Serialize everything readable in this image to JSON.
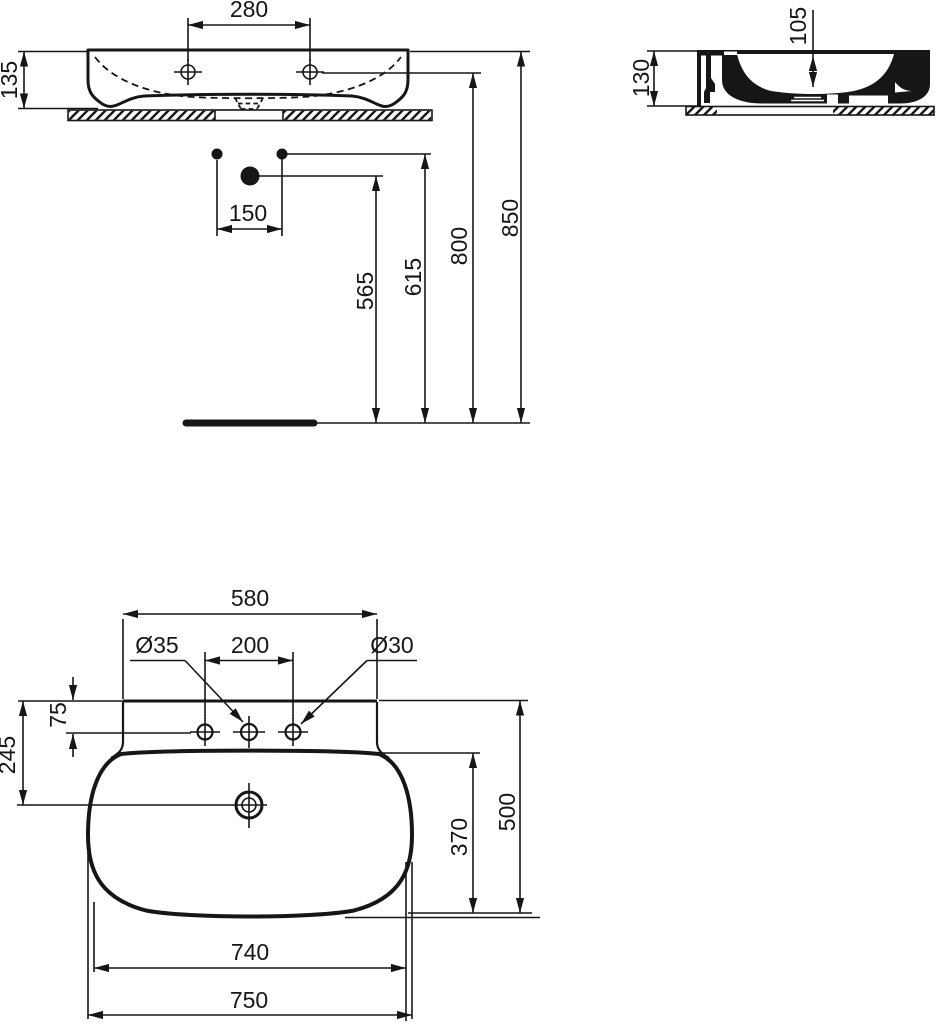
{
  "drawing": {
    "title": "wall-hung washbasin technical drawing",
    "units": "mm",
    "front": {
      "tap_hole_spacing": "280",
      "rim_height": "135",
      "fixing_spacing": "150",
      "drain_height": "565",
      "fixing_height": "615",
      "tap_hole_height": "800",
      "rim_top_height": "850"
    },
    "side": {
      "total_height": "130",
      "basin_inner_depth": "105"
    },
    "plan": {
      "back_width": "580",
      "center_hole_dia": "Ø35",
      "outer_hole_spacing": "200",
      "side_hole_dia": "Ø30",
      "hole_row_offset": "75",
      "drain_offset": "245",
      "bowl_front_depth": "370",
      "total_depth": "500",
      "body_width": "740",
      "total_width": "750"
    },
    "line_color": "#161616"
  }
}
